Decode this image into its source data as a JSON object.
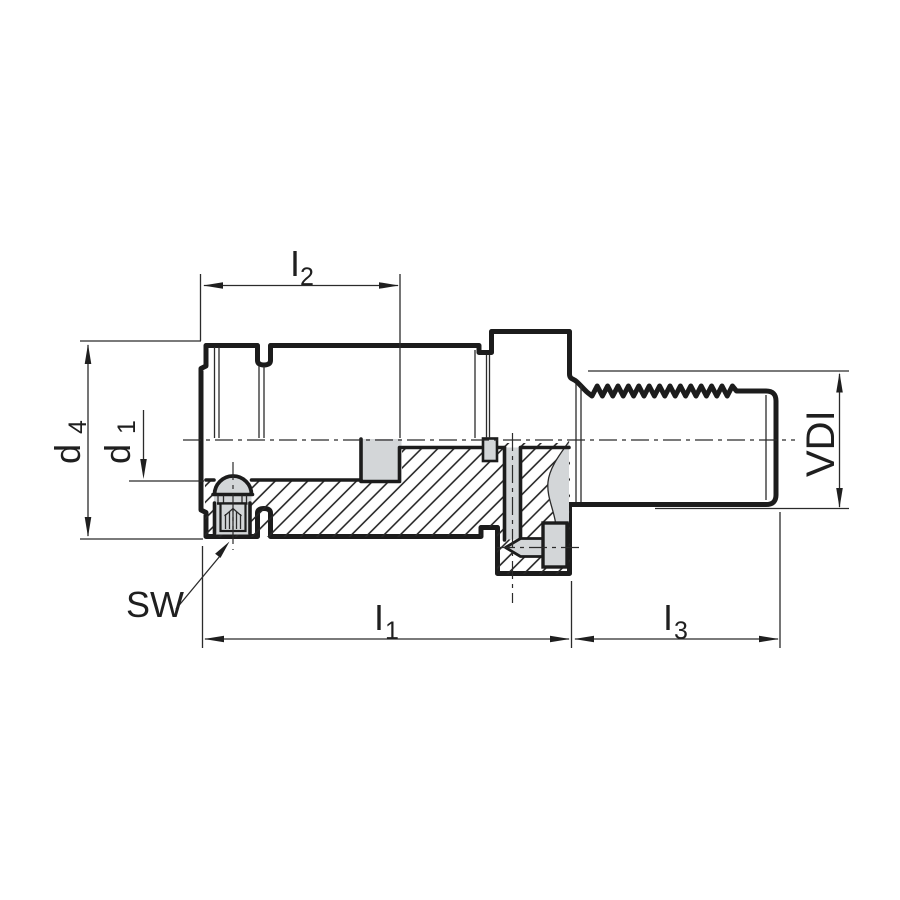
{
  "drawing": {
    "type": "technical-cross-section",
    "labels": {
      "i2": {
        "base": "I",
        "sub": "2"
      },
      "d4": {
        "base": "d",
        "sub": "4"
      },
      "d1": {
        "base": "d",
        "sub": "1"
      },
      "sw": {
        "base": "SW"
      },
      "i1": {
        "base": "I",
        "sub": "1"
      },
      "i3": {
        "base": "I",
        "sub": "3"
      },
      "vdi": {
        "base": "VDI"
      }
    },
    "colors": {
      "body_fill": "#d3d6d8",
      "outline": "#1c1c1c",
      "thin_line": "#2b2b2b",
      "background": "#ffffff"
    }
  }
}
